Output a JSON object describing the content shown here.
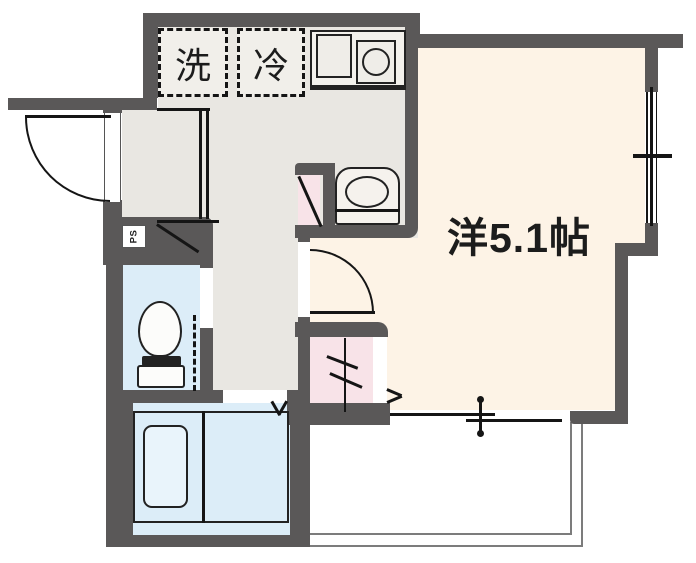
{
  "floorplan": {
    "labels": {
      "washer": "洗",
      "fridge": "冷",
      "main_room": "洋5.1帖",
      "pipe_space": "PS"
    },
    "colors": {
      "wall": "#5a5858",
      "hall_floor": "#e9e7e2",
      "room_floor": "#fdf3e6",
      "wet_floor": "#dcedf8",
      "closet_pink": "#f8e3e8",
      "appliance_box_fill": "#f1efea",
      "balcony_border": "#7c7c7c",
      "line": "#151515"
    }
  }
}
